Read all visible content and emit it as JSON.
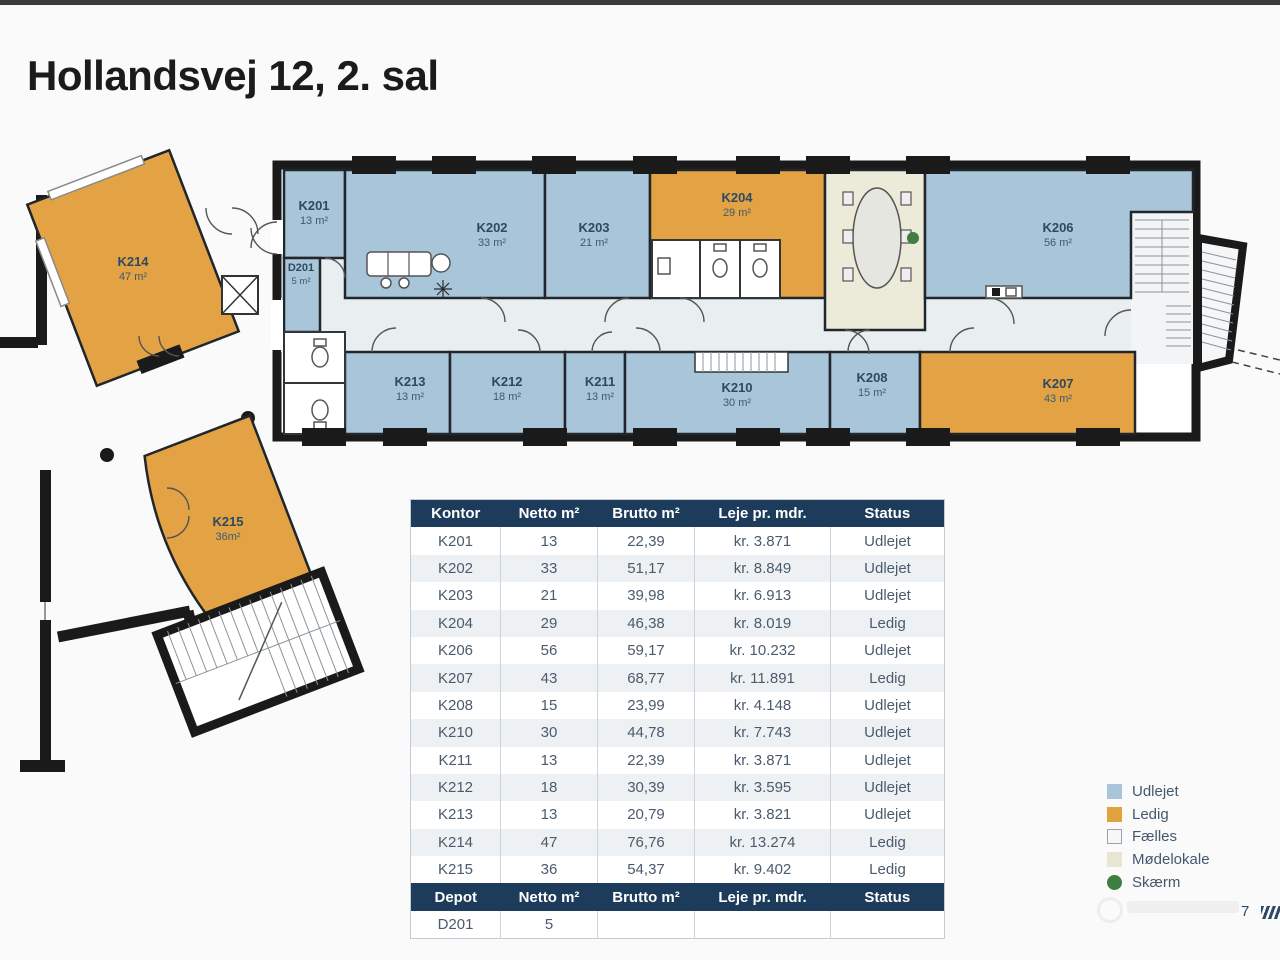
{
  "page": {
    "title": "Hollandsvej 12, 2. sal",
    "page_number": "7"
  },
  "table": {
    "header": {
      "kontor": "Kontor",
      "netto": "Netto m²",
      "brutto": "Brutto m²",
      "leje": "Leje  pr. mdr.",
      "status": "Status"
    },
    "rows": [
      {
        "kontor": "K201",
        "netto": "13",
        "brutto": "22,39",
        "leje": "kr. 3.871",
        "status": "Udlejet"
      },
      {
        "kontor": "K202",
        "netto": "33",
        "brutto": "51,17",
        "leje": "kr. 8.849",
        "status": "Udlejet"
      },
      {
        "kontor": "K203",
        "netto": "21",
        "brutto": "39,98",
        "leje": "kr. 6.913",
        "status": "Udlejet"
      },
      {
        "kontor": "K204",
        "netto": "29",
        "brutto": "46,38",
        "leje": "kr. 8.019",
        "status": "Ledig"
      },
      {
        "kontor": "K206",
        "netto": "56",
        "brutto": "59,17",
        "leje": "kr. 10.232",
        "status": "Udlejet"
      },
      {
        "kontor": "K207",
        "netto": "43",
        "brutto": "68,77",
        "leje": "kr. 11.891",
        "status": "Ledig"
      },
      {
        "kontor": "K208",
        "netto": "15",
        "brutto": "23,99",
        "leje": "kr. 4.148",
        "status": "Udlejet"
      },
      {
        "kontor": "K210",
        "netto": "30",
        "brutto": "44,78",
        "leje": "kr. 7.743",
        "status": "Udlejet"
      },
      {
        "kontor": "K211",
        "netto": "13",
        "brutto": "22,39",
        "leje": "kr. 3.871",
        "status": "Udlejet"
      },
      {
        "kontor": "K212",
        "netto": "18",
        "brutto": "30,39",
        "leje": "kr. 3.595",
        "status": "Udlejet"
      },
      {
        "kontor": "K213",
        "netto": "13",
        "brutto": "20,79",
        "leje": "kr. 3.821",
        "status": "Udlejet"
      },
      {
        "kontor": "K214",
        "netto": "47",
        "brutto": "76,76",
        "leje": "kr. 13.274",
        "status": "Ledig"
      },
      {
        "kontor": "K215",
        "netto": "36",
        "brutto": "54,37",
        "leje": "kr. 9.402",
        "status": "Ledig"
      }
    ],
    "depot_header": {
      "kontor": "Depot",
      "netto": "Netto m²",
      "brutto": "Brutto m²",
      "leje": "Leje  pr. mdr.",
      "status": "Status"
    },
    "depot_rows": [
      {
        "kontor": "D201",
        "netto": "5",
        "brutto": "",
        "leje": "",
        "status": ""
      }
    ]
  },
  "legend": {
    "items": [
      {
        "label": "Udlejet",
        "color": "#a9c5d9"
      },
      {
        "label": "Ledig",
        "color": "#e0a33e"
      },
      {
        "label": "Fælles",
        "color": "#f7f7f7"
      },
      {
        "label": "Mødelokale",
        "color": "#e8e5d2"
      },
      {
        "label": "Skærm",
        "color": "#3e7e3e"
      }
    ]
  },
  "floorplan": {
    "colors": {
      "udlejet": "#a9c5d9",
      "ledig": "#e3a244",
      "faelles": "#e9eef1",
      "moedelokale": "#ecead9",
      "skaerm": "#3e7e3e",
      "wall": "#1a1a1a"
    },
    "rooms": {
      "K201": {
        "name": "K201",
        "area": "13 m²"
      },
      "D201": {
        "name": "D201",
        "area": "5 m²"
      },
      "K202": {
        "name": "K202",
        "area": "33 m²"
      },
      "K203": {
        "name": "K203",
        "area": "21 m²"
      },
      "K204": {
        "name": "K204",
        "area": "29 m²"
      },
      "K206": {
        "name": "K206",
        "area": "56 m²"
      },
      "K207": {
        "name": "K207",
        "area": "43 m²"
      },
      "K208": {
        "name": "K208",
        "area": "15 m²"
      },
      "K210": {
        "name": "K210",
        "area": "30 m²"
      },
      "K211": {
        "name": "K211",
        "area": "13 m²"
      },
      "K212": {
        "name": "K212",
        "area": "18 m²"
      },
      "K213": {
        "name": "K213",
        "area": "13 m²"
      },
      "K214": {
        "name": "K214",
        "area": "47 m²"
      },
      "K215": {
        "name": "K215",
        "area": "36m²"
      }
    }
  }
}
